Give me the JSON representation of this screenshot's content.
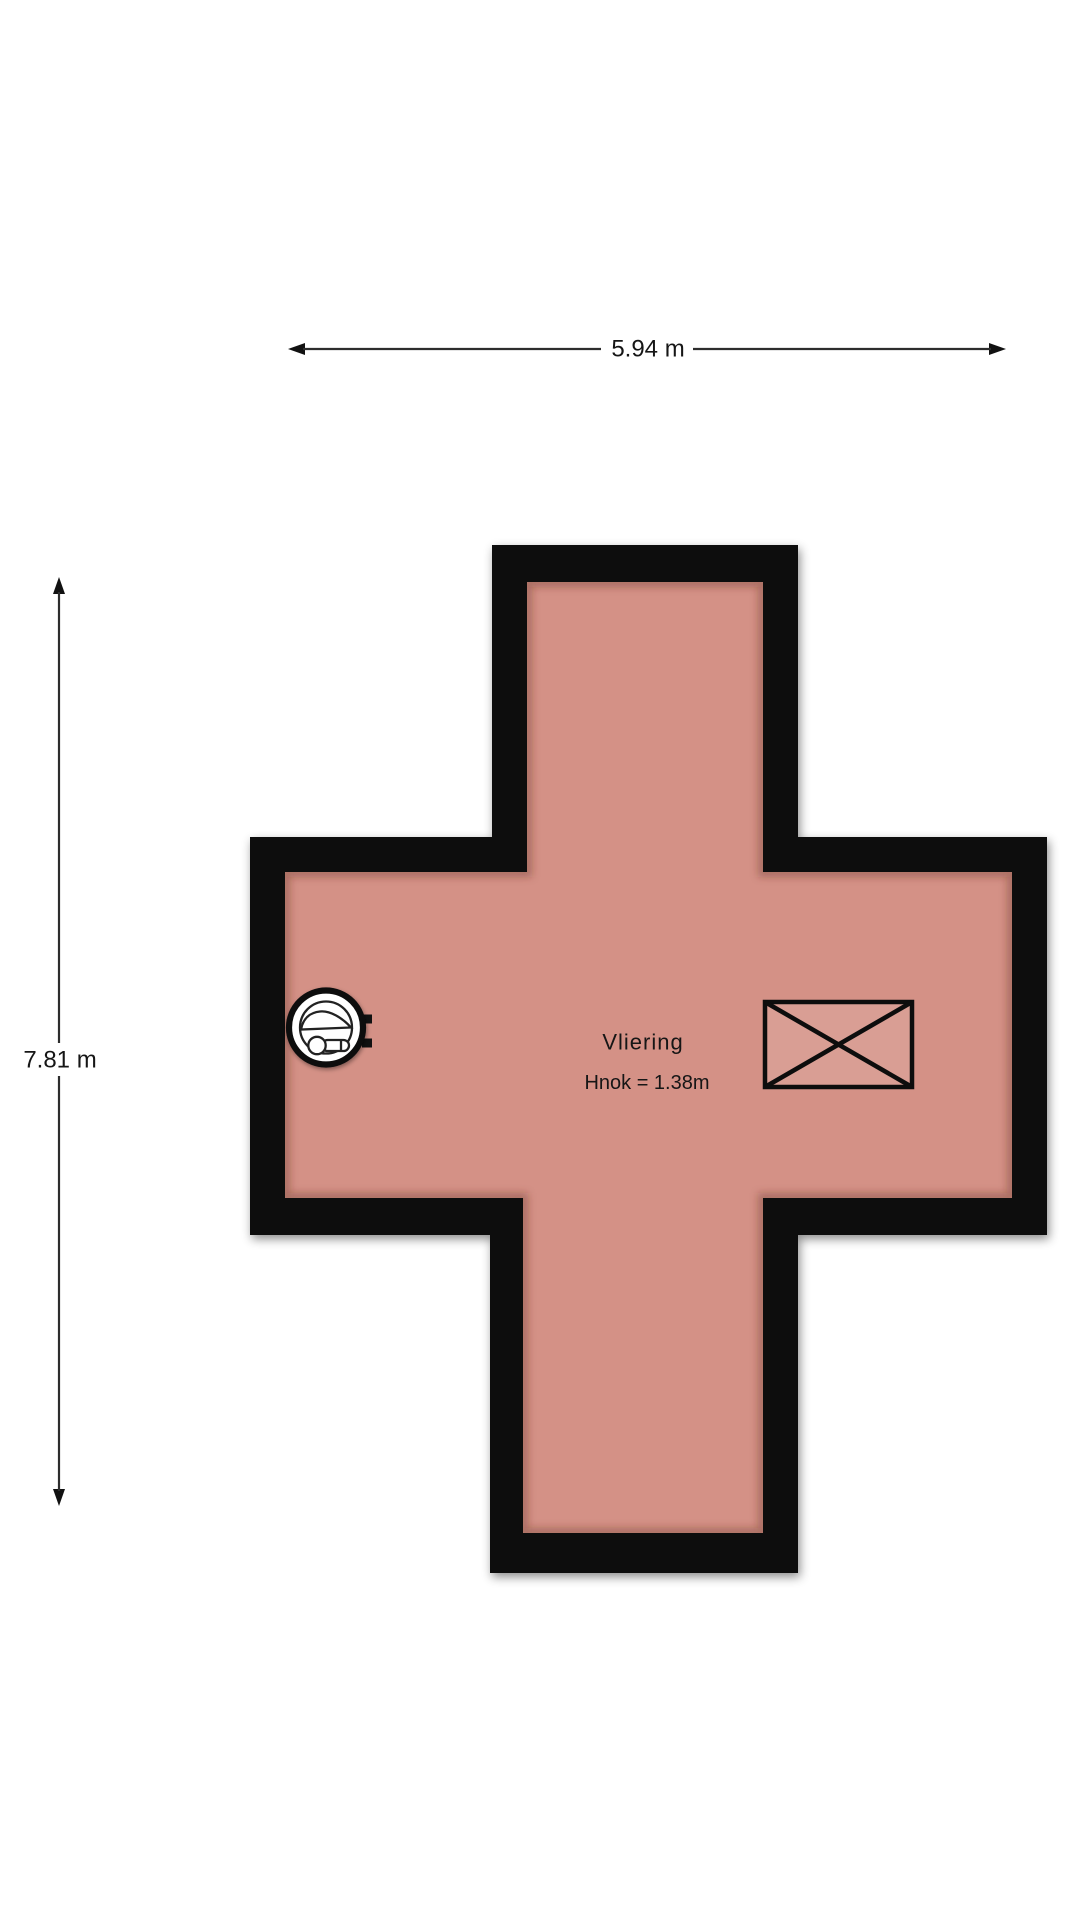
{
  "page": {
    "background": "#ffffff"
  },
  "colors": {
    "wall": "#070707",
    "floor": "#d49186",
    "text": "#161616",
    "dimension_line": "#2d2d2d"
  },
  "dimensions": {
    "width": {
      "label": "5.94 m"
    },
    "height": {
      "label": "7.81 m"
    }
  },
  "room": {
    "label": "Vliering",
    "ridge_height": "Hnok = 1.38m"
  },
  "icons": {
    "fixture": "boiler-icon",
    "opening": "crossed-box-icon",
    "width_arrow": "horizontal-dimension-arrow",
    "height_arrow": "vertical-dimension-arrow"
  }
}
